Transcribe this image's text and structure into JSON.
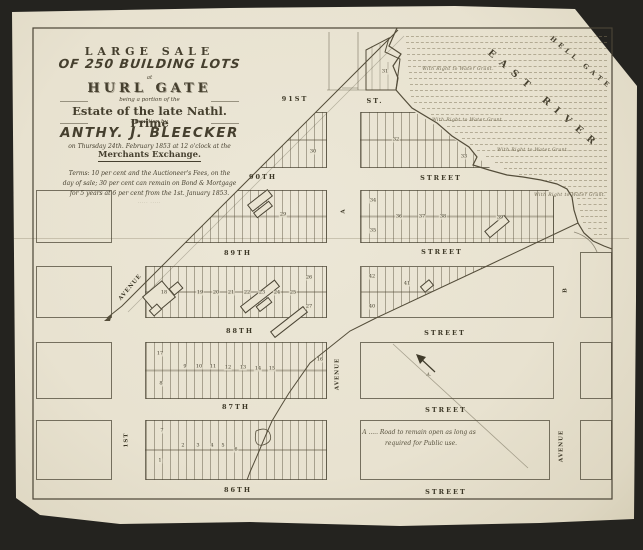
{
  "colors": {
    "paper": "#eae4d2",
    "ink": "#453f2e",
    "faint_ink": "#6e6750",
    "background": "#24231f"
  },
  "title_block": {
    "line1": "LARGE SALE",
    "line2": "OF 250 BUILDING LOTS",
    "line3": "at",
    "line4": "HURL GATE",
    "line5": "being a portion of the",
    "line6": "Estate of the late Nathl. Prime",
    "line7": "at auction by",
    "line8": "ANTHY. J. BLEECKER",
    "line9": "on Thursday 24th. February 1853 at 12 o'clock at the",
    "line10": "Merchants Exchange.",
    "terms1": "Terms: 10 per cent and the Auctioneer's Fees, on the",
    "terms2": "day of sale; 30 per cent can remain on Bond & Mortgage",
    "terms3": "for 5 years at 6 per cent from the 1st. January 1853.",
    "credit": "····· ·····"
  },
  "water": {
    "hell_gate": "HELL GATE",
    "east_river": "EAST RIVER",
    "grant_label": "With Right to Water Grant.",
    "grants": [
      {
        "x": 458,
        "y": 70
      },
      {
        "x": 468,
        "y": 121
      },
      {
        "x": 533,
        "y": 151
      },
      {
        "x": 570,
        "y": 196
      }
    ]
  },
  "note": {
    "line1": "A ..... Road to remain open as long as",
    "line2": "required for Public use.",
    "marker": "A."
  },
  "streets": [
    {
      "name": "91st",
      "left": "91ST",
      "lx": 295,
      "ly": 99,
      "right": "ST.",
      "rx": 375,
      "ry": 101
    },
    {
      "name": "90th",
      "left": "90TH",
      "lx": 263,
      "ly": 177,
      "right": "STREET",
      "rx": 441,
      "ry": 178
    },
    {
      "name": "89th",
      "left": "89TH",
      "lx": 238,
      "ly": 253,
      "right": "STREET",
      "rx": 442,
      "ry": 252
    },
    {
      "name": "88th",
      "left": "88TH",
      "lx": 240,
      "ly": 331,
      "right": "STREET",
      "rx": 445,
      "ry": 333
    },
    {
      "name": "87th",
      "left": "87TH",
      "lx": 236,
      "ly": 407,
      "right": "STREET",
      "rx": 446,
      "ry": 410
    },
    {
      "name": "86th",
      "left": "86TH",
      "lx": 238,
      "ly": 490,
      "right": "STREET",
      "rx": 446,
      "ry": 492
    }
  ],
  "avenues": [
    {
      "label": "AVENUE",
      "x": 131,
      "y": 288,
      "rot": -50
    },
    {
      "label": "1ST",
      "x": 127,
      "y": 440,
      "rot": -90
    },
    {
      "label": "A",
      "x": 344,
      "y": 211,
      "rot": -90
    },
    {
      "label": "AVENUE",
      "x": 338,
      "y": 374,
      "rot": -90
    },
    {
      "label": "B",
      "x": 566,
      "y": 290,
      "rot": -90
    },
    {
      "label": "AVENUE",
      "x": 562,
      "y": 446,
      "rot": -90
    }
  ],
  "lots": [
    {
      "n": "1",
      "x": 160,
      "y": 461
    },
    {
      "n": "2",
      "x": 183,
      "y": 446
    },
    {
      "n": "3",
      "x": 198,
      "y": 446
    },
    {
      "n": "4",
      "x": 212,
      "y": 446
    },
    {
      "n": "5",
      "x": 223,
      "y": 446
    },
    {
      "n": "6",
      "x": 236,
      "y": 450
    },
    {
      "n": "7",
      "x": 162,
      "y": 431
    },
    {
      "n": "8",
      "x": 161,
      "y": 384
    },
    {
      "n": "9",
      "x": 185,
      "y": 367
    },
    {
      "n": "10",
      "x": 199,
      "y": 367
    },
    {
      "n": "11",
      "x": 213,
      "y": 367
    },
    {
      "n": "12",
      "x": 228,
      "y": 368
    },
    {
      "n": "13",
      "x": 243,
      "y": 368
    },
    {
      "n": "14",
      "x": 258,
      "y": 369
    },
    {
      "n": "15",
      "x": 272,
      "y": 369
    },
    {
      "n": "16",
      "x": 320,
      "y": 360
    },
    {
      "n": "17",
      "x": 160,
      "y": 354
    },
    {
      "n": "18",
      "x": 164,
      "y": 293
    },
    {
      "n": "19",
      "x": 200,
      "y": 293
    },
    {
      "n": "20",
      "x": 216,
      "y": 293
    },
    {
      "n": "21",
      "x": 231,
      "y": 293
    },
    {
      "n": "22",
      "x": 247,
      "y": 293
    },
    {
      "n": "23",
      "x": 262,
      "y": 293
    },
    {
      "n": "24",
      "x": 277,
      "y": 293
    },
    {
      "n": "25",
      "x": 293,
      "y": 293
    },
    {
      "n": "26",
      "x": 309,
      "y": 278
    },
    {
      "n": "27",
      "x": 309,
      "y": 307
    },
    {
      "n": "29",
      "x": 283,
      "y": 215
    },
    {
      "n": "30",
      "x": 313,
      "y": 152
    },
    {
      "n": "31",
      "x": 385,
      "y": 72
    },
    {
      "n": "32",
      "x": 396,
      "y": 140
    },
    {
      "n": "33",
      "x": 464,
      "y": 157
    },
    {
      "n": "34",
      "x": 373,
      "y": 201
    },
    {
      "n": "35",
      "x": 373,
      "y": 231
    },
    {
      "n": "36",
      "x": 399,
      "y": 217
    },
    {
      "n": "37",
      "x": 422,
      "y": 217
    },
    {
      "n": "38",
      "x": 443,
      "y": 217
    },
    {
      "n": "39",
      "x": 500,
      "y": 218
    },
    {
      "n": "40",
      "x": 372,
      "y": 307
    },
    {
      "n": "41",
      "x": 407,
      "y": 284
    },
    {
      "n": "42",
      "x": 372,
      "y": 277
    }
  ]
}
